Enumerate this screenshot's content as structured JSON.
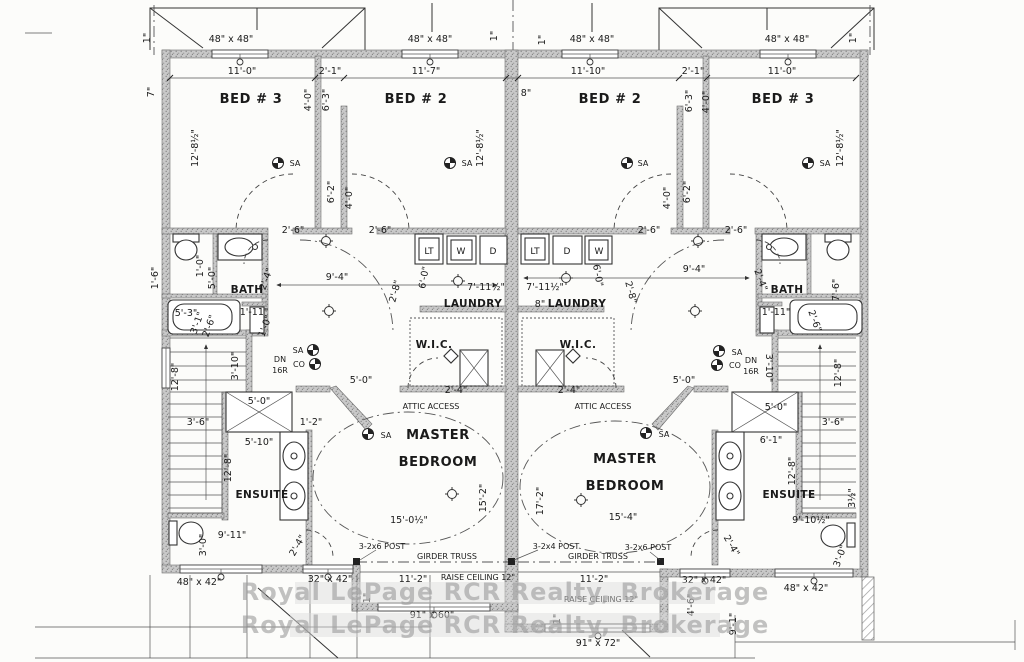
{
  "watermark": {
    "line1": "Royal LePage RCR Realty, Brokerage",
    "line2": "Royal LePage RCR Realty, Brokerage"
  },
  "rooms": {
    "bed3": "BED # 3",
    "bed2": "BED # 2",
    "bath": "BATH",
    "laundry": "LAUNDRY",
    "wic": "W.I.C.",
    "master_line1": "MASTER",
    "master_line2": "BEDROOM",
    "ensuite": "ENSUITE"
  },
  "windows": {
    "w48x48": "48\" x 48\"",
    "w48x42": "48\" x 42\"",
    "w32x42": "32\" x 42\"",
    "w91x60": "91\" x 60\"",
    "w91x72": "91\" x 72\""
  },
  "dims": {
    "d1": "1\"",
    "d7": "7\"",
    "d8": "8\"",
    "d11_0": "11'-0\"",
    "d11_7": "11'-7\"",
    "d11_10": "11'-10\"",
    "d2_1": "2'-1\"",
    "d12_8half": "12'-8½\"",
    "d4_0": "4'-0\"",
    "d6_3": "6'-3\"",
    "d6_2": "6'-2\"",
    "d2_6": "2'-6\"",
    "d9_4": "9'-4\"",
    "d2_4": "2'-4\"",
    "d2_8": "2'-8\"",
    "d7_11half": "7'-11½\"",
    "d6_0": "6'-0\"",
    "d1_0": "1'-0\"",
    "d5_0": "5'-0\"",
    "d5_3": "5'-3\"",
    "d3_1": "3'-1\"",
    "d1_11": "1'-11\"",
    "d1_6": "1'-6\"",
    "d7_6": "7'-6\"",
    "d3_10": "3'-10\"",
    "d12_8": "12'-8\"",
    "d3_6": "3'-6\"",
    "d5_10": "5'-10\"",
    "d1_2": "1'-2\"",
    "d6_1": "6'-1\"",
    "d15_2": "15'-2\"",
    "d17_2": "17'-2\"",
    "d15_0half": "15'-0½\"",
    "d15_4": "15'-4\"",
    "d11_2": "11'-2\"",
    "d9_11": "9'-11\"",
    "d9_10half": "9'-10½\"",
    "d3_0": "3'-0\"",
    "d9_1": "9'-1\"",
    "d4_6": "4'-6\"",
    "d3half": "3½\""
  },
  "annotations": {
    "sa": "SA",
    "co": "CO",
    "dn": "DN",
    "riser": "16R",
    "attic": "ATTIC ACCESS",
    "girder": "GIRDER TRUSS",
    "raise": "RAISE CEILING 12\"",
    "post6": "3-2x6 POST",
    "post4": "3-2x4 POST",
    "lt": "LT",
    "washer": "W",
    "dryer": "D"
  }
}
